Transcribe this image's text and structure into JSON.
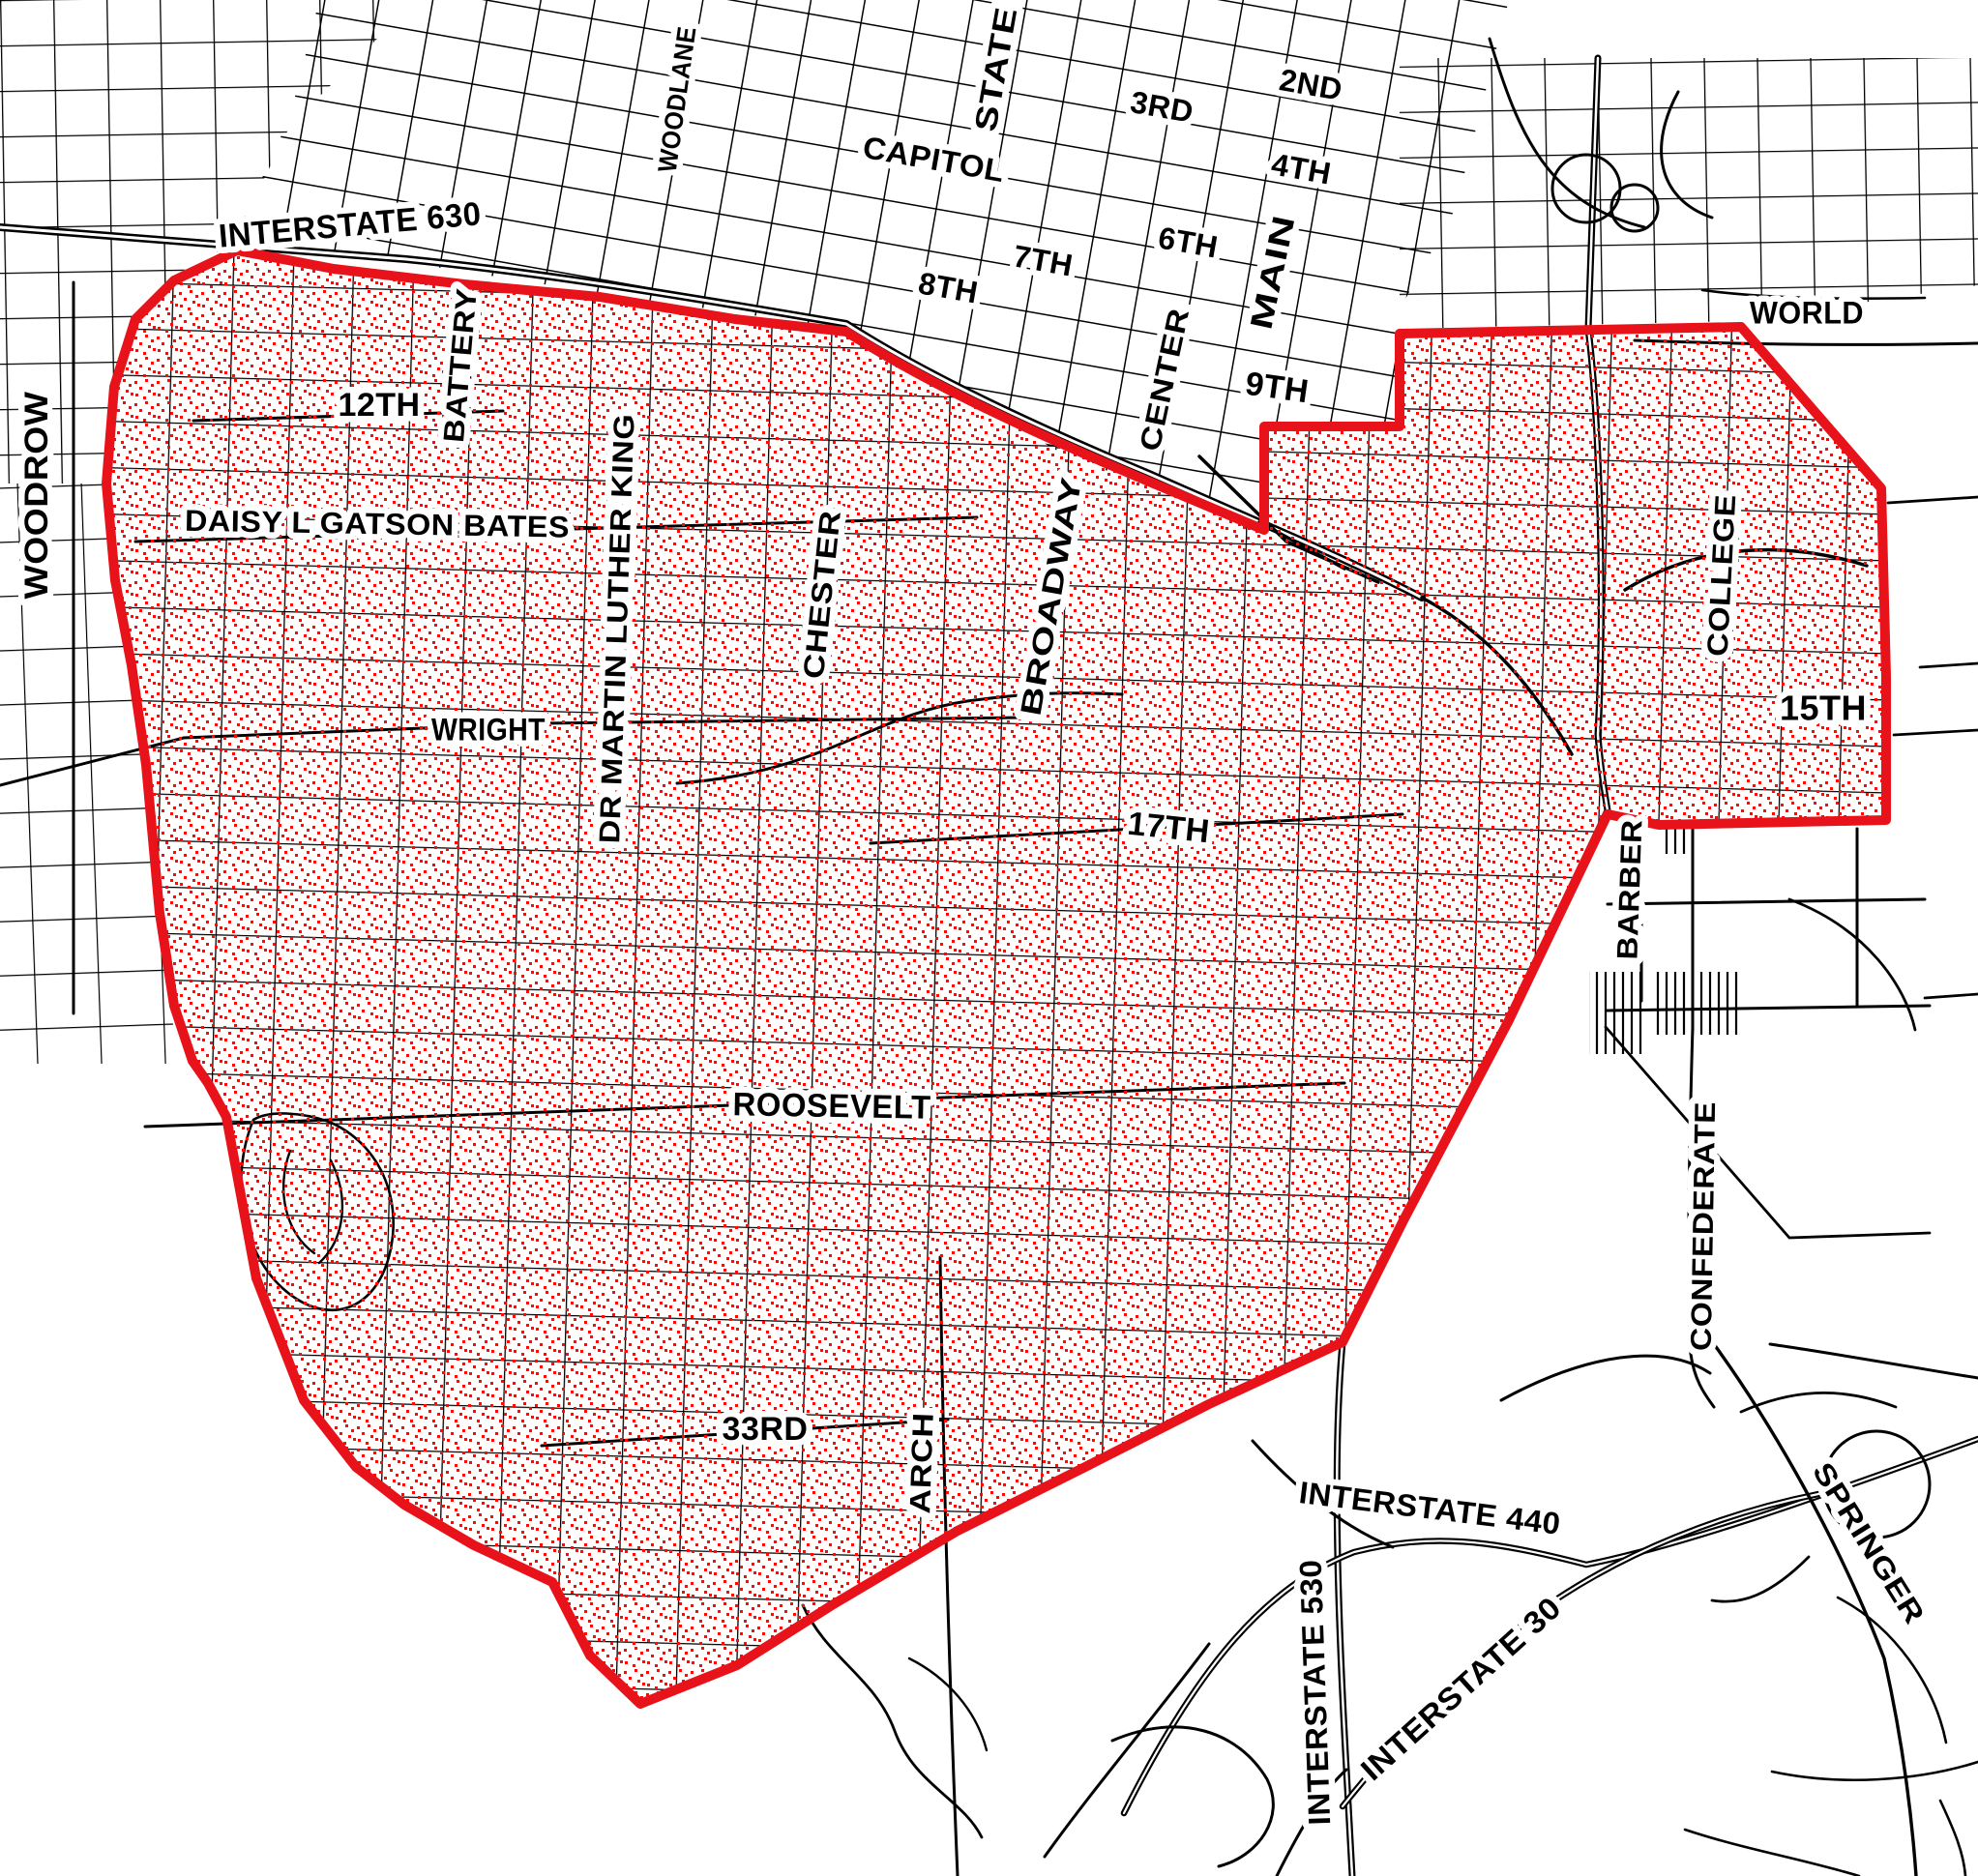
{
  "map": {
    "description": "Street map with red-outlined district filled with red stipple dots",
    "region_outline_color": "#e8121a",
    "stipple_dot_color": "#ff0808",
    "road_color": "#000000",
    "background_color": "#ffffff"
  },
  "labels": [
    {
      "id": "woodrow",
      "text": "WOODROW"
    },
    {
      "id": "interstate-630",
      "text": "INTERSTATE 630"
    },
    {
      "id": "woodlane",
      "text": "WOODLANE"
    },
    {
      "id": "state",
      "text": "STATE"
    },
    {
      "id": "capitol",
      "text": "CAPITOL"
    },
    {
      "id": "2nd",
      "text": "2ND"
    },
    {
      "id": "3rd",
      "text": "3RD"
    },
    {
      "id": "4th",
      "text": "4TH"
    },
    {
      "id": "6th",
      "text": "6TH"
    },
    {
      "id": "7th",
      "text": "7TH"
    },
    {
      "id": "8th",
      "text": "8TH"
    },
    {
      "id": "main",
      "text": "MAIN"
    },
    {
      "id": "center",
      "text": "CENTER"
    },
    {
      "id": "9th",
      "text": "9TH"
    },
    {
      "id": "world",
      "text": "WORLD"
    },
    {
      "id": "battery",
      "text": "BATTERY"
    },
    {
      "id": "12th",
      "text": "12TH"
    },
    {
      "id": "daisy-l-gatson-bates",
      "text": "DAISY L GATSON BATES"
    },
    {
      "id": "dr-martin-luther-king",
      "text": "DR MARTIN LUTHER KING"
    },
    {
      "id": "chester",
      "text": "CHESTER"
    },
    {
      "id": "broadway",
      "text": "BROADWAY"
    },
    {
      "id": "17th",
      "text": "17TH"
    },
    {
      "id": "college",
      "text": "COLLEGE"
    },
    {
      "id": "15th",
      "text": "15TH"
    },
    {
      "id": "wright",
      "text": "WRIGHT"
    },
    {
      "id": "barber",
      "text": "BARBER"
    },
    {
      "id": "roosevelt",
      "text": "ROOSEVELT"
    },
    {
      "id": "confederate",
      "text": "CONFEDERATE"
    },
    {
      "id": "33rd",
      "text": "33RD"
    },
    {
      "id": "arch",
      "text": "ARCH"
    },
    {
      "id": "interstate-440",
      "text": "INTERSTATE 440"
    },
    {
      "id": "interstate-530",
      "text": "INTERSTATE 530"
    },
    {
      "id": "interstate-30",
      "text": "INTERSTATE 30"
    },
    {
      "id": "springer",
      "text": "SPRINGER"
    }
  ]
}
